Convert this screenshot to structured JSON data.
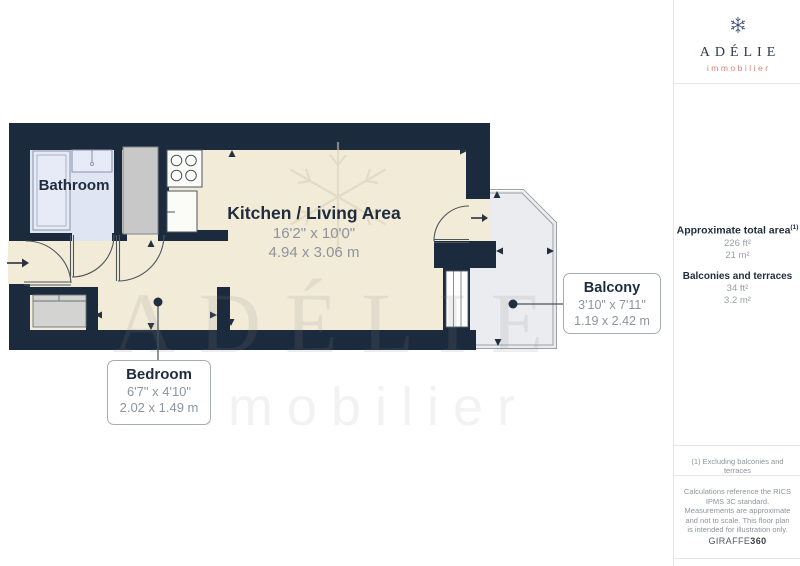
{
  "theme": {
    "wall": "#1b2a3c",
    "floor-cream": "#f2ebd8",
    "floor-bath": "#dfe5f2",
    "floor-balcony": "#eaecef",
    "fixture-white": "#fbfbf8",
    "wardrobe-gray": "#c7c8c7",
    "closet-gray": "#d3d3d2",
    "line-dark": "#4d565e",
    "label-navy": "#1f2c3e",
    "dim-gray": "#8d949d",
    "divider": "#e6e6e6",
    "accent-coral": "#dd8274",
    "logo-navy": "#2b3950",
    "muted-gray": "#9aa0a7",
    "watermark": "#8a8a8a"
  },
  "floor_plan": {
    "bathroom": {
      "name": "Bathroom"
    },
    "kitchen_living": {
      "name": "Kitchen / Living Area",
      "imperial": "16'2\" x 10'0\"",
      "metric": "4.94 x 3.06 m"
    },
    "bedroom": {
      "name": "Bedroom",
      "imperial": "6'7\" x 4'10\"",
      "metric": "2.02 x 1.49 m"
    },
    "balcony": {
      "name": "Balcony",
      "imperial": "3'10\" x 7'11\"",
      "metric": "1.19 x 2.42 m"
    }
  },
  "watermark": {
    "title": "ADÉLIE",
    "subtitle": "immobilier"
  },
  "sidebar": {
    "logo": {
      "title": "ADÉLIE",
      "subtitle": "immobilier"
    },
    "total_area_label": "Approximate total area",
    "total_area_sup": "(1)",
    "total_area_imperial": "226 ft²",
    "total_area_metric": "21 m²",
    "balconies_label": "Balconies and terraces",
    "balconies_imperial": "34 ft²",
    "balconies_metric": "3.2 m²",
    "footnote": "(1) Excluding balconies and terraces",
    "disclaimer": "Calculations reference the RICS IPMS 3C standard. Measurements are approximate and not to scale. This floor plan is intended for illustration only.",
    "brand": "GIRAFFE",
    "brand_suffix": "360"
  }
}
